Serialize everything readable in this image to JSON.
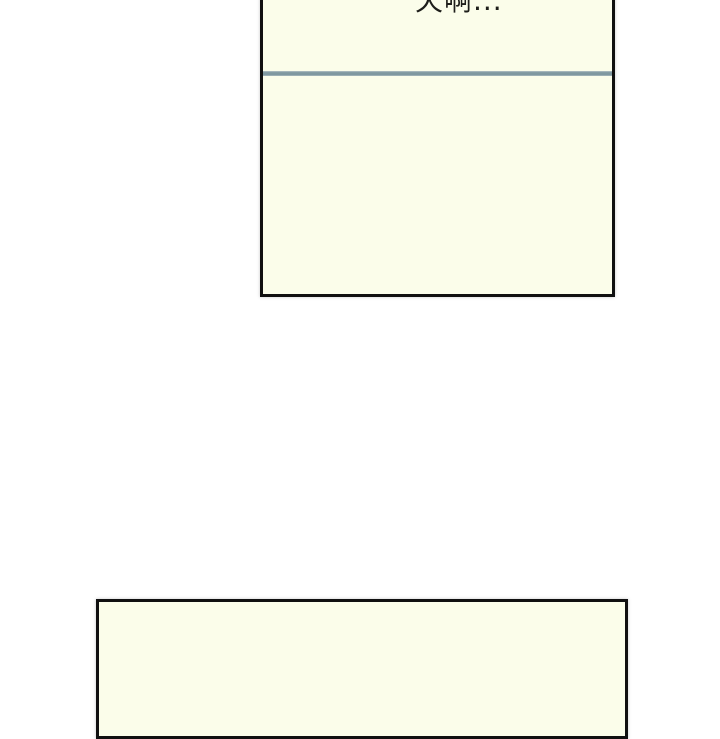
{
  "page": {
    "background": "#ffffff"
  },
  "panels": [
    {
      "name": "top-panel",
      "dialogue": "天啊...",
      "fill": "#fbfdea",
      "border_color": "#101010",
      "divider_color": "#7f98a0",
      "text_color": "#1e1e1a"
    },
    {
      "name": "bottom-panel",
      "fill": "#fbfdea",
      "border_color": "#101010"
    }
  ]
}
